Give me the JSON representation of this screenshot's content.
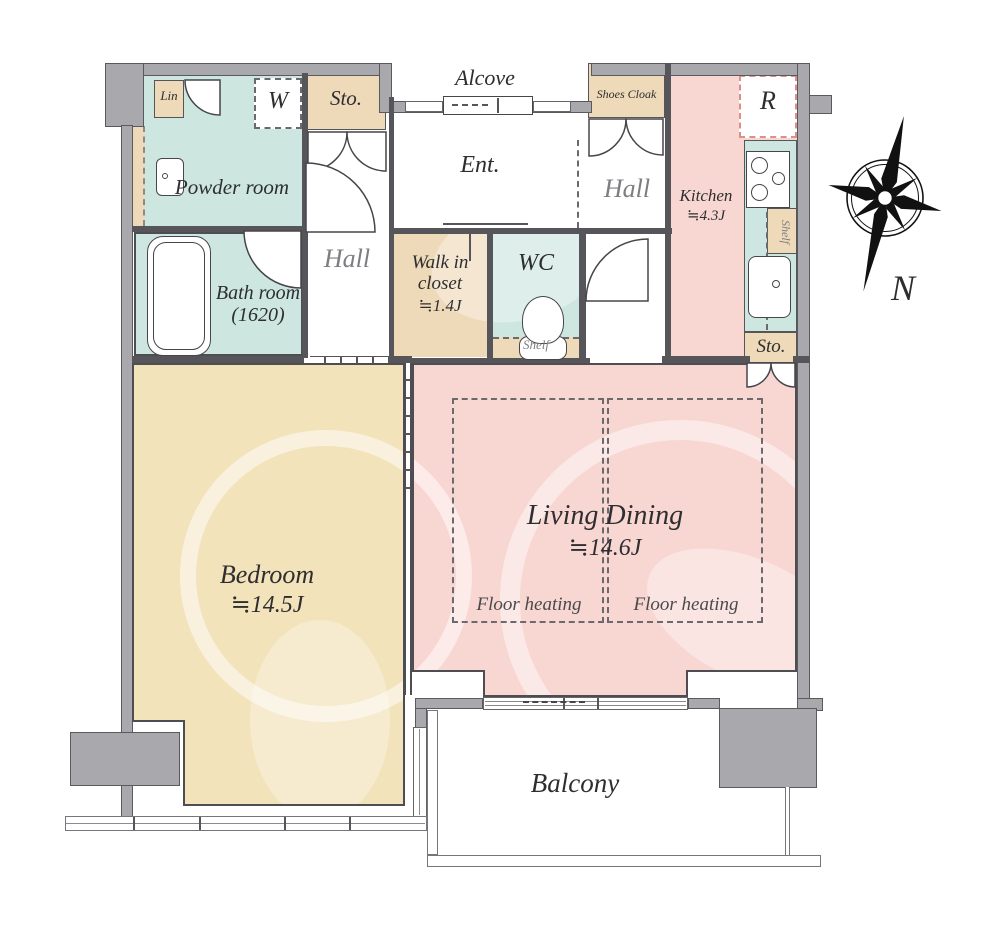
{
  "plan_title": "1LDK apartment floor plan",
  "colors": {
    "wall_gray": "#a9a9ad",
    "line_dark": "#55555a",
    "wet_area_teal": "#cde7e0",
    "storage_tan": "#eed9b9",
    "living_pink": "#f8d7d3",
    "bedroom_cream": "#f3e3ba"
  },
  "rooms": {
    "alcove": {
      "label": "Alcove"
    },
    "ent": {
      "label": "Ent."
    },
    "shoes_cloak": {
      "label": "Shoes Cloak"
    },
    "hall_right": {
      "label": "Hall"
    },
    "hall_center": {
      "label": "Hall"
    },
    "kitchen": {
      "label": "Kitchen",
      "size": "≒4.3J"
    },
    "refrigerator": {
      "label": "R"
    },
    "kitchen_shelf": {
      "label": "Shelf"
    },
    "sto_top": {
      "label": "Sto."
    },
    "sto_right": {
      "label": "Sto."
    },
    "washer": {
      "label": "W"
    },
    "linen": {
      "label": "Lin"
    },
    "powder_room": {
      "label": "Powder room"
    },
    "bath_room": {
      "label": "Bath room",
      "size": "(1620)"
    },
    "walk_in_closet": {
      "label": "Walk in closet",
      "size": "≒1.4J"
    },
    "wc": {
      "label": "WC"
    },
    "wc_shelf": {
      "label": "Shelf"
    },
    "bedroom": {
      "label": "Bedroom",
      "size": "≒14.5J"
    },
    "living_dining": {
      "label": "Living Dining",
      "size": "≒14.6J"
    },
    "floor_heating_left": {
      "label": "Floor heating"
    },
    "floor_heating_right": {
      "label": "Floor heating"
    },
    "balcony": {
      "label": "Balcony"
    }
  },
  "compass": {
    "north_label": "N"
  }
}
